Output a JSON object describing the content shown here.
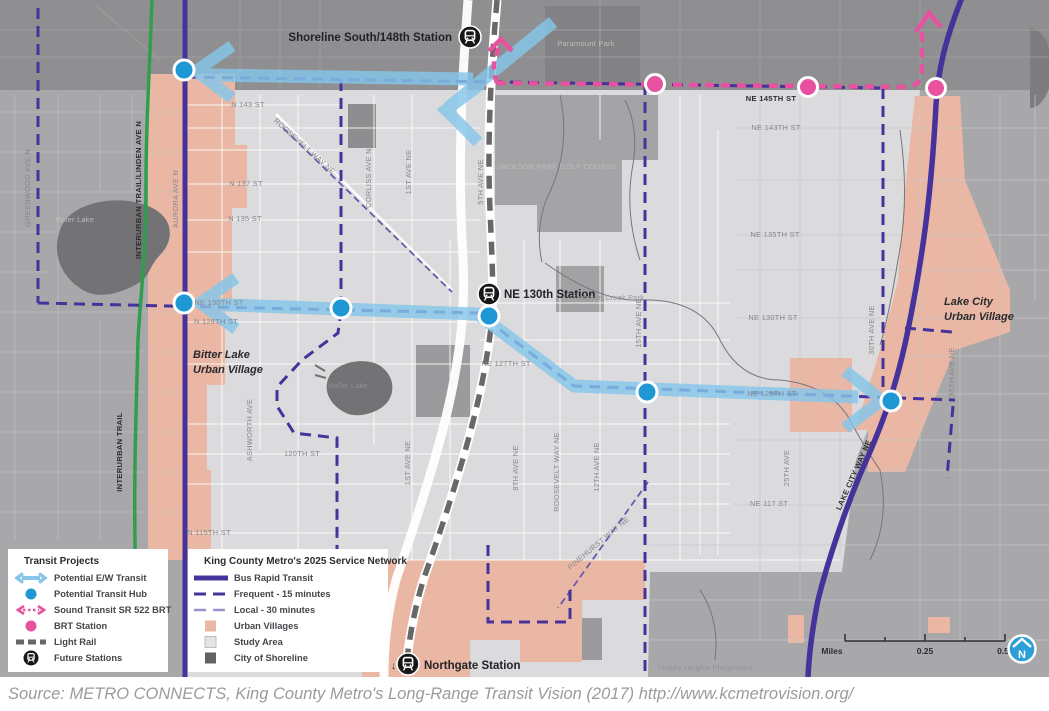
{
  "source_text": "Source: METRO CONNECTS, King County Metro's Long-Range Transit Vision (2017) http://www.kcmetrovision.org/",
  "stations": {
    "shoreline": "Shoreline South/148th Station",
    "ne130": "NE 130th Station",
    "northgate": "Northgate Station",
    "northgate_arrow": "↓"
  },
  "villages": {
    "bitter1": "Bitter Lake",
    "bitter2": "Urban Village",
    "lakecity1": "Lake City",
    "lakecity2": "Urban Village"
  },
  "streets": {
    "greenwood": "GREENWOOD AVE N",
    "interurban_linden": "INTERURBAN TRAIL/LINDEN AVE N",
    "aurora": "AURORA AVE N",
    "interurban": "INTERURBAN TRAIL",
    "ashworth": "ASHWORTH AVE",
    "corliss": "CORLISS AVE N",
    "first_n": "1ST AVE NE",
    "first_s": "1ST AVE NE",
    "fifth": "5TH AVE NE",
    "eighth": "8TH AVE NE",
    "roosevelt_n": "ROOSEVELT WAY NE",
    "roosevelt_s": "ROOSEVELT WAY NE",
    "twelfth": "12TH AVE NE",
    "pinehurst": "PINEHURST WAY NE",
    "fifteenth": "15TH AVE NE",
    "twentyfifth": "25TH AVE",
    "thirtieth": "30TH AVE NE",
    "thirtyfifth": "35TH AVE NE",
    "lakecity_way": "LAKE CITY WAY NE",
    "n143": "N 143 ST",
    "n137": "N 137 ST",
    "n135": "N 135 ST",
    "ne130w": "NE 130TH ST",
    "n128": "N 128TH ST",
    "s120": "120TH ST",
    "n115": "N 115TH ST",
    "ne127": "NE 127TH ST",
    "ne145": "NE 145TH ST",
    "ne143": "NE 143TH ST",
    "ne135": "NE 135TH ST",
    "ne130e": "NE 130TH ST",
    "ne125": "NE 125TH ST",
    "ne117": "NE 117 ST"
  },
  "parks": {
    "paramount": "Paramount Park",
    "jackson": "JACKSON PARK GOLF COURSE",
    "thornton": "Thornton Creek Park",
    "victory": "Victory Heights Playground",
    "bitter_lake": "Bitter Lake",
    "haller_lake": "Haller Lake"
  },
  "legend_projects": {
    "title": "Transit Projects",
    "items": [
      {
        "icon": "ew-transit-arrow-icon",
        "label": "Potential E/W Transit"
      },
      {
        "icon": "transit-hub-dot-icon",
        "label": "Potential Transit Hub"
      },
      {
        "icon": "sr522-brt-arrow-icon",
        "label": "Sound Transit SR 522 BRT"
      },
      {
        "icon": "brt-station-dot-icon",
        "label": "BRT Station"
      },
      {
        "icon": "light-rail-dash-icon",
        "label": "Light Rail"
      },
      {
        "icon": "future-station-icon",
        "label": "Future Stations"
      }
    ]
  },
  "legend_network": {
    "title": "King County Metro's 2025 Service Network",
    "items": [
      {
        "icon": "brt-line-icon",
        "label": "Bus Rapid Transit"
      },
      {
        "icon": "frequent-line-icon",
        "label": "Frequent - 15 minutes"
      },
      {
        "icon": "local-line-icon",
        "label": "Local - 30 minutes"
      },
      {
        "icon": "urban-villages-swatch",
        "label": "Urban Villages"
      },
      {
        "icon": "study-area-swatch",
        "label": "Study Area"
      },
      {
        "icon": "city-of-shoreline-swatch",
        "label": "City of Shoreline"
      }
    ]
  },
  "scalebar": {
    "unit": "Miles",
    "mid": "0.25",
    "end": "0.5"
  },
  "compass": {
    "letter": "N"
  },
  "colors": {
    "bus_rapid_transit_purple": "#45339b",
    "local_purple": "#6a58ad",
    "ew_transit_blue": "#85c6ea",
    "hub_blue": "#1e98d5",
    "brt_pink": "#e8519f",
    "urban_village_salmon": "#e9b7a3",
    "study_area_gray": "#dbdbdd",
    "city_of_shoreline_gray": "#8f8f91",
    "interurban_trail_green": "#2f9e4f",
    "light_rail_gray": "#68686a"
  }
}
